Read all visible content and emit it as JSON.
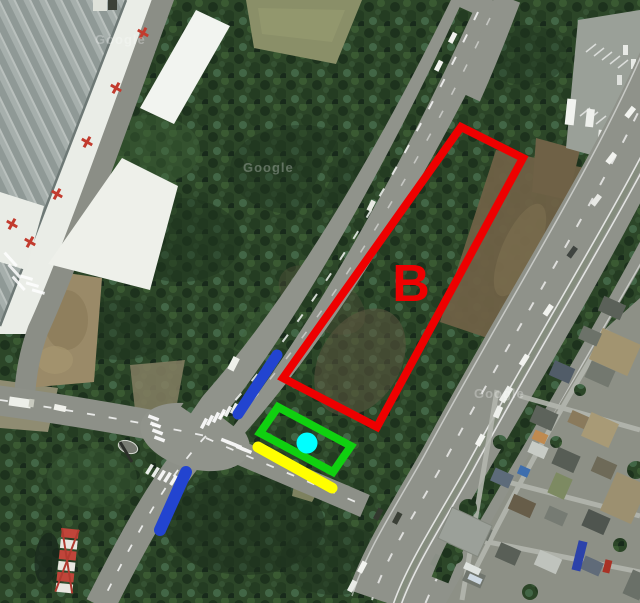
{
  "map": {
    "type": "satellite-aerial-photo",
    "watermark_text": "Google",
    "watermarks": [
      {
        "x": 95,
        "y": 44
      },
      {
        "x": 243,
        "y": 172
      },
      {
        "x": 474,
        "y": 398
      }
    ]
  },
  "annotations": {
    "label_b": {
      "text": "B",
      "x": 411,
      "y": 301,
      "color": "#ee0000",
      "font_size": 52
    },
    "red_area": {
      "points": "461,127 523,158 377,427 283,378",
      "color": "#ee0000",
      "stroke_width": 8
    },
    "green_rect": {
      "points": "278,407 351,446 333,472 260,433",
      "color": "#10d010",
      "stroke_width": 8
    },
    "cyan_dot": {
      "cx": 307,
      "cy": 443,
      "r": 10.5,
      "color": "#00ffff"
    },
    "yellow_line": {
      "x1": 258,
      "y1": 447,
      "x2": 332,
      "y2": 488,
      "color": "#ffff00",
      "stroke_width": 11
    },
    "blue_line_upper": {
      "x1": 277,
      "y1": 355,
      "x2": 238,
      "y2": 414,
      "color": "#2244d0",
      "stroke_width": 11
    },
    "blue_line_lower": {
      "x1": 186,
      "y1": 472,
      "x2": 160,
      "y2": 530,
      "color": "#2244d0",
      "stroke_width": 12
    }
  }
}
